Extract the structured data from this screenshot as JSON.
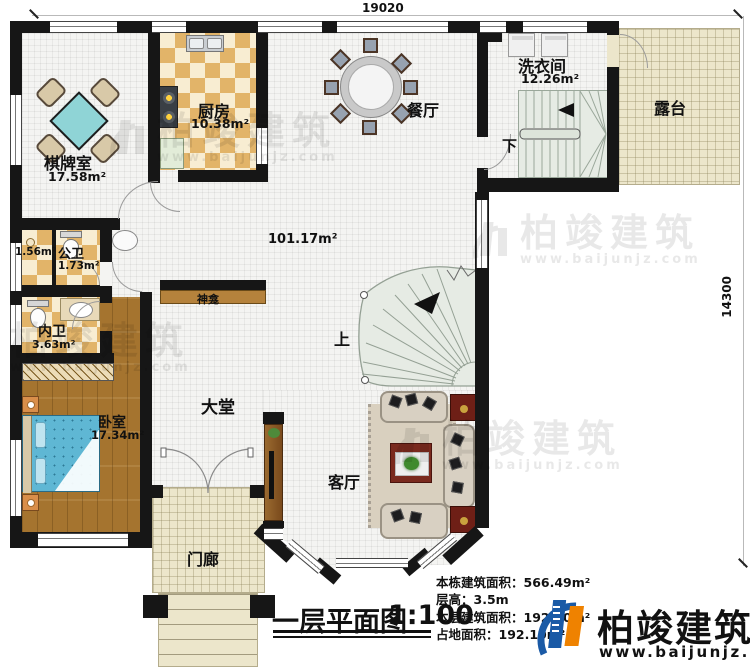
{
  "dimensions": {
    "width_mm": "19020",
    "height_mm": "14300"
  },
  "rooms": {
    "chess": {
      "name": "棋牌室",
      "area": "17.58m²"
    },
    "kitchen": {
      "name": "厨房",
      "area": "10.38m²"
    },
    "dining": {
      "name": "餐厅"
    },
    "laundry": {
      "name": "洗衣间",
      "area": "12.26m²"
    },
    "terrace": {
      "name": "露台"
    },
    "shower_room": {
      "area": "1.56m²"
    },
    "public_bath": {
      "name": "公卫",
      "area": "1.73m²"
    },
    "inner_bath": {
      "name": "内卫",
      "area": "3.63m²"
    },
    "bedroom": {
      "name": "卧室",
      "area": "17.34m²"
    },
    "hall": {
      "name": "大堂",
      "area": "101.17m²"
    },
    "living": {
      "name": "客厅"
    },
    "porch": {
      "name": "门廊"
    },
    "shrine": {
      "name": "神龛"
    },
    "stair_up_label": "上",
    "stair_down_label": "下"
  },
  "titleblock": {
    "title": "一层平面图",
    "scale": "1:100",
    "building_area": "本栋建筑面积：566.49m²",
    "floor_height": "层高：3.5m",
    "floor_area": "本层建筑面积：192.10m²",
    "footprint_area": "占地面积：192.10m²"
  },
  "brand": {
    "name": "柏竣建筑",
    "website": "www.baijunjz.com"
  },
  "watermark": {
    "name": "柏竣建筑",
    "website": "www.baijunjz.com"
  },
  "colors": {
    "wall": "#161616",
    "checker_tan": "#e2b469",
    "wood": "#a5742f",
    "terrace_beige": "#ece6cb",
    "table_cyan": "#8fd4d6",
    "logo_blue": "#1a5aa6",
    "logo_orange": "#ef8200"
  }
}
